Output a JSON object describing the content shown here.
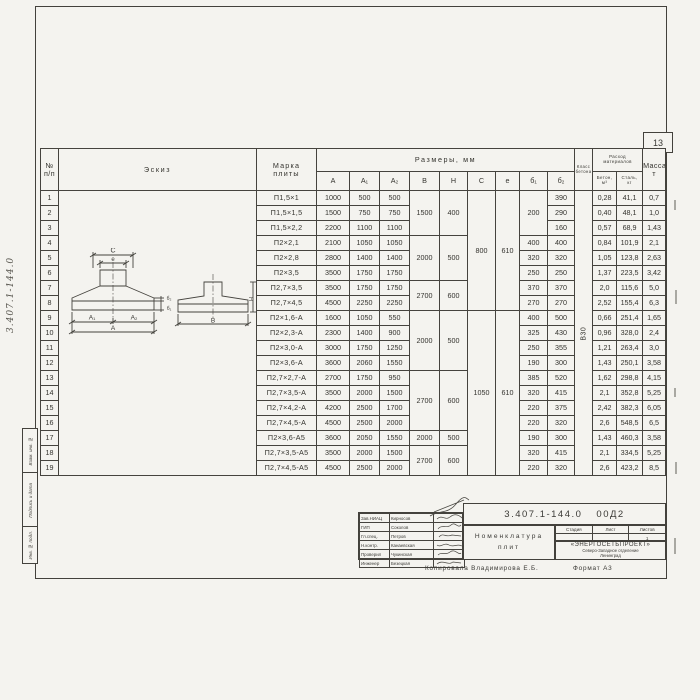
{
  "page": {
    "sheet_number": "13",
    "doc_number_vertical": "3.407.1-144.0",
    "copied_by": "Копировала  Владимирова Е.Б.",
    "format_note": "Формат А3"
  },
  "margin_boxes": [
    "Взам. инв. №",
    "Подпись и дата",
    "Инв. № подл."
  ],
  "table": {
    "headers": {
      "n1": "№",
      "n2": "п/п",
      "eskiz": "Эскиз",
      "marka1": "Марка",
      "marka2": "плиты",
      "razmery": "Размеры,  мм",
      "dims": [
        "А",
        "А₁",
        "А₂",
        "В",
        "Н",
        "С",
        "е",
        "б₁",
        "б₂"
      ],
      "klass1": "Класс",
      "klass2": "бетона",
      "concrete_class": "В30",
      "rashod1": "Расход",
      "rashod2": "материалов",
      "beton1": "Бетон,",
      "beton2": "м³",
      "stal1": "Сталь,",
      "stal2": "кг",
      "massa1": "Масса,",
      "massa2": "т"
    },
    "rows": [
      {
        "n": "1",
        "marka": "П1,5×1",
        "a": "1000",
        "a1": "500",
        "a2": "500",
        "b": "1500",
        "h": "400",
        "c": "800",
        "e": "610",
        "b1": "200",
        "b2": "390",
        "bet": "0,28",
        "st": "41,1",
        "mas": "0,7"
      },
      {
        "n": "2",
        "marka": "П1,5×1,5",
        "a": "1500",
        "a1": "750",
        "a2": "750",
        "b2": "290",
        "bet": "0,40",
        "st": "48,1",
        "mas": "1,0"
      },
      {
        "n": "3",
        "marka": "П1,5×2,2",
        "a": "2200",
        "a1": "1100",
        "a2": "1100",
        "b2": "160",
        "bet": "0,57",
        "st": "68,9",
        "mas": "1,43"
      },
      {
        "n": "4",
        "marka": "П2×2,1",
        "a": "2100",
        "a1": "1050",
        "a2": "1050",
        "b": "2000",
        "h": "500",
        "b1": "400",
        "b2": "400",
        "bet": "0,84",
        "st": "101,9",
        "mas": "2,1"
      },
      {
        "n": "5",
        "marka": "П2×2,8",
        "a": "2800",
        "a1": "1400",
        "a2": "1400",
        "b1": "320",
        "b2": "320",
        "bet": "1,05",
        "st": "123,8",
        "mas": "2,63"
      },
      {
        "n": "6",
        "marka": "П2×3,5",
        "a": "3500",
        "a1": "1750",
        "a2": "1750",
        "b1": "250",
        "b2": "250",
        "bet": "1,37",
        "st": "223,5",
        "mas": "3,42"
      },
      {
        "n": "7",
        "marka": "П2,7×3,5",
        "a": "3500",
        "a1": "1750",
        "a2": "1750",
        "b": "2700",
        "h": "600",
        "b1": "370",
        "b2": "370",
        "bet": "2,0",
        "st": "115,6",
        "mas": "5,0"
      },
      {
        "n": "8",
        "marka": "П2,7×4,5",
        "a": "4500",
        "a1": "2250",
        "a2": "2250",
        "b1": "270",
        "b2": "270",
        "bet": "2,52",
        "st": "155,4",
        "mas": "6,3"
      },
      {
        "n": "9",
        "marka": "П2×1,6-А",
        "a": "1600",
        "a1": "1050",
        "a2": "550",
        "b": "2000",
        "h": "500",
        "c": "1050",
        "e": "610",
        "b1": "400",
        "b2": "500",
        "bet": "0,66",
        "st": "251,4",
        "mas": "1,65"
      },
      {
        "n": "10",
        "marka": "П2×2,3-А",
        "a": "2300",
        "a1": "1400",
        "a2": "900",
        "b1": "325",
        "b2": "430",
        "bet": "0,96",
        "st": "328,0",
        "mas": "2,4"
      },
      {
        "n": "11",
        "marka": "П2×3,0-А",
        "a": "3000",
        "a1": "1750",
        "a2": "1250",
        "b1": "250",
        "b2": "355",
        "bet": "1,21",
        "st": "263,4",
        "mas": "3,0"
      },
      {
        "n": "12",
        "marka": "П2×3,6-А",
        "a": "3600",
        "a1": "2060",
        "a2": "1550",
        "b1": "190",
        "b2": "300",
        "bet": "1,43",
        "st": "250,1",
        "mas": "3,58"
      },
      {
        "n": "13",
        "marka": "П2,7×2,7-А",
        "a": "2700",
        "a1": "1750",
        "a2": "950",
        "b": "2700",
        "h": "600",
        "b1": "385",
        "b2": "520",
        "bet": "1,62",
        "st": "298,8",
        "mas": "4,15"
      },
      {
        "n": "14",
        "marka": "П2,7×3,5-А",
        "a": "3500",
        "a1": "2000",
        "a2": "1500",
        "b1": "320",
        "b2": "415",
        "bet": "2,1",
        "st": "352,8",
        "mas": "5,25"
      },
      {
        "n": "15",
        "marka": "П2,7×4,2-А",
        "a": "4200",
        "a1": "2500",
        "a2": "1700",
        "b1": "220",
        "b2": "375",
        "bet": "2,42",
        "st": "382,3",
        "mas": "6,05"
      },
      {
        "n": "16",
        "marka": "П2,7×4,5-А",
        "a": "4500",
        "a1": "2500",
        "a2": "2000",
        "b1": "220",
        "b2": "320",
        "bet": "2,6",
        "st": "548,5",
        "mas": "6,5"
      },
      {
        "n": "17",
        "marka": "П2×3,6-А5",
        "a": "3600",
        "a1": "2050",
        "a2": "1550",
        "b": "2000",
        "h": "500",
        "b1": "190",
        "b2": "300",
        "bet": "1,43",
        "st": "460,3",
        "mas": "3,58"
      },
      {
        "n": "18",
        "marka": "П2,7×3,5-А5",
        "a": "3500",
        "a1": "2000",
        "a2": "1500",
        "b": "2700",
        "h": "600",
        "b1": "320",
        "b2": "415",
        "bet": "2,1",
        "st": "334,5",
        "mas": "5,25"
      },
      {
        "n": "19",
        "marka": "П2,7×4,5-А5",
        "a": "4500",
        "a1": "2500",
        "a2": "2000",
        "b1": "220",
        "b2": "320",
        "bet": "2,6",
        "st": "423,2",
        "mas": "8,5"
      }
    ]
  },
  "sketch": {
    "labels": {
      "c": "С",
      "e": "е",
      "b2": "б₂",
      "b1": "б₁",
      "a1": "А₁",
      "a2": "А₂",
      "a": "А",
      "b": "В",
      "h": "Н"
    }
  },
  "title_block": {
    "doc_number": "3.407.1-144.0",
    "doc_code": "00Д2",
    "title_line1": "Номенклатура",
    "title_line2": "плит",
    "stage_label": "Стадия",
    "sheet_label": "Лист",
    "sheets_label": "Листов",
    "sheets_value": "1",
    "org_name": "«ЭНЕРГОСЕТЬПРОЕКТ»",
    "org_branch": "Северо-Западное отделение",
    "org_city": "Ленинград",
    "signers": [
      {
        "role": "Зав.НИАЦ",
        "name": "Кирносов"
      },
      {
        "role": "ГИП",
        "name": "Соколов"
      },
      {
        "role": "Гл.спец.",
        "name": "Петров"
      },
      {
        "role": "Н.контр.",
        "name": "Канаевская"
      },
      {
        "role": "Проверил",
        "name": "Чукинская"
      },
      {
        "role": "Инженер",
        "name": "Безецкая"
      }
    ]
  }
}
